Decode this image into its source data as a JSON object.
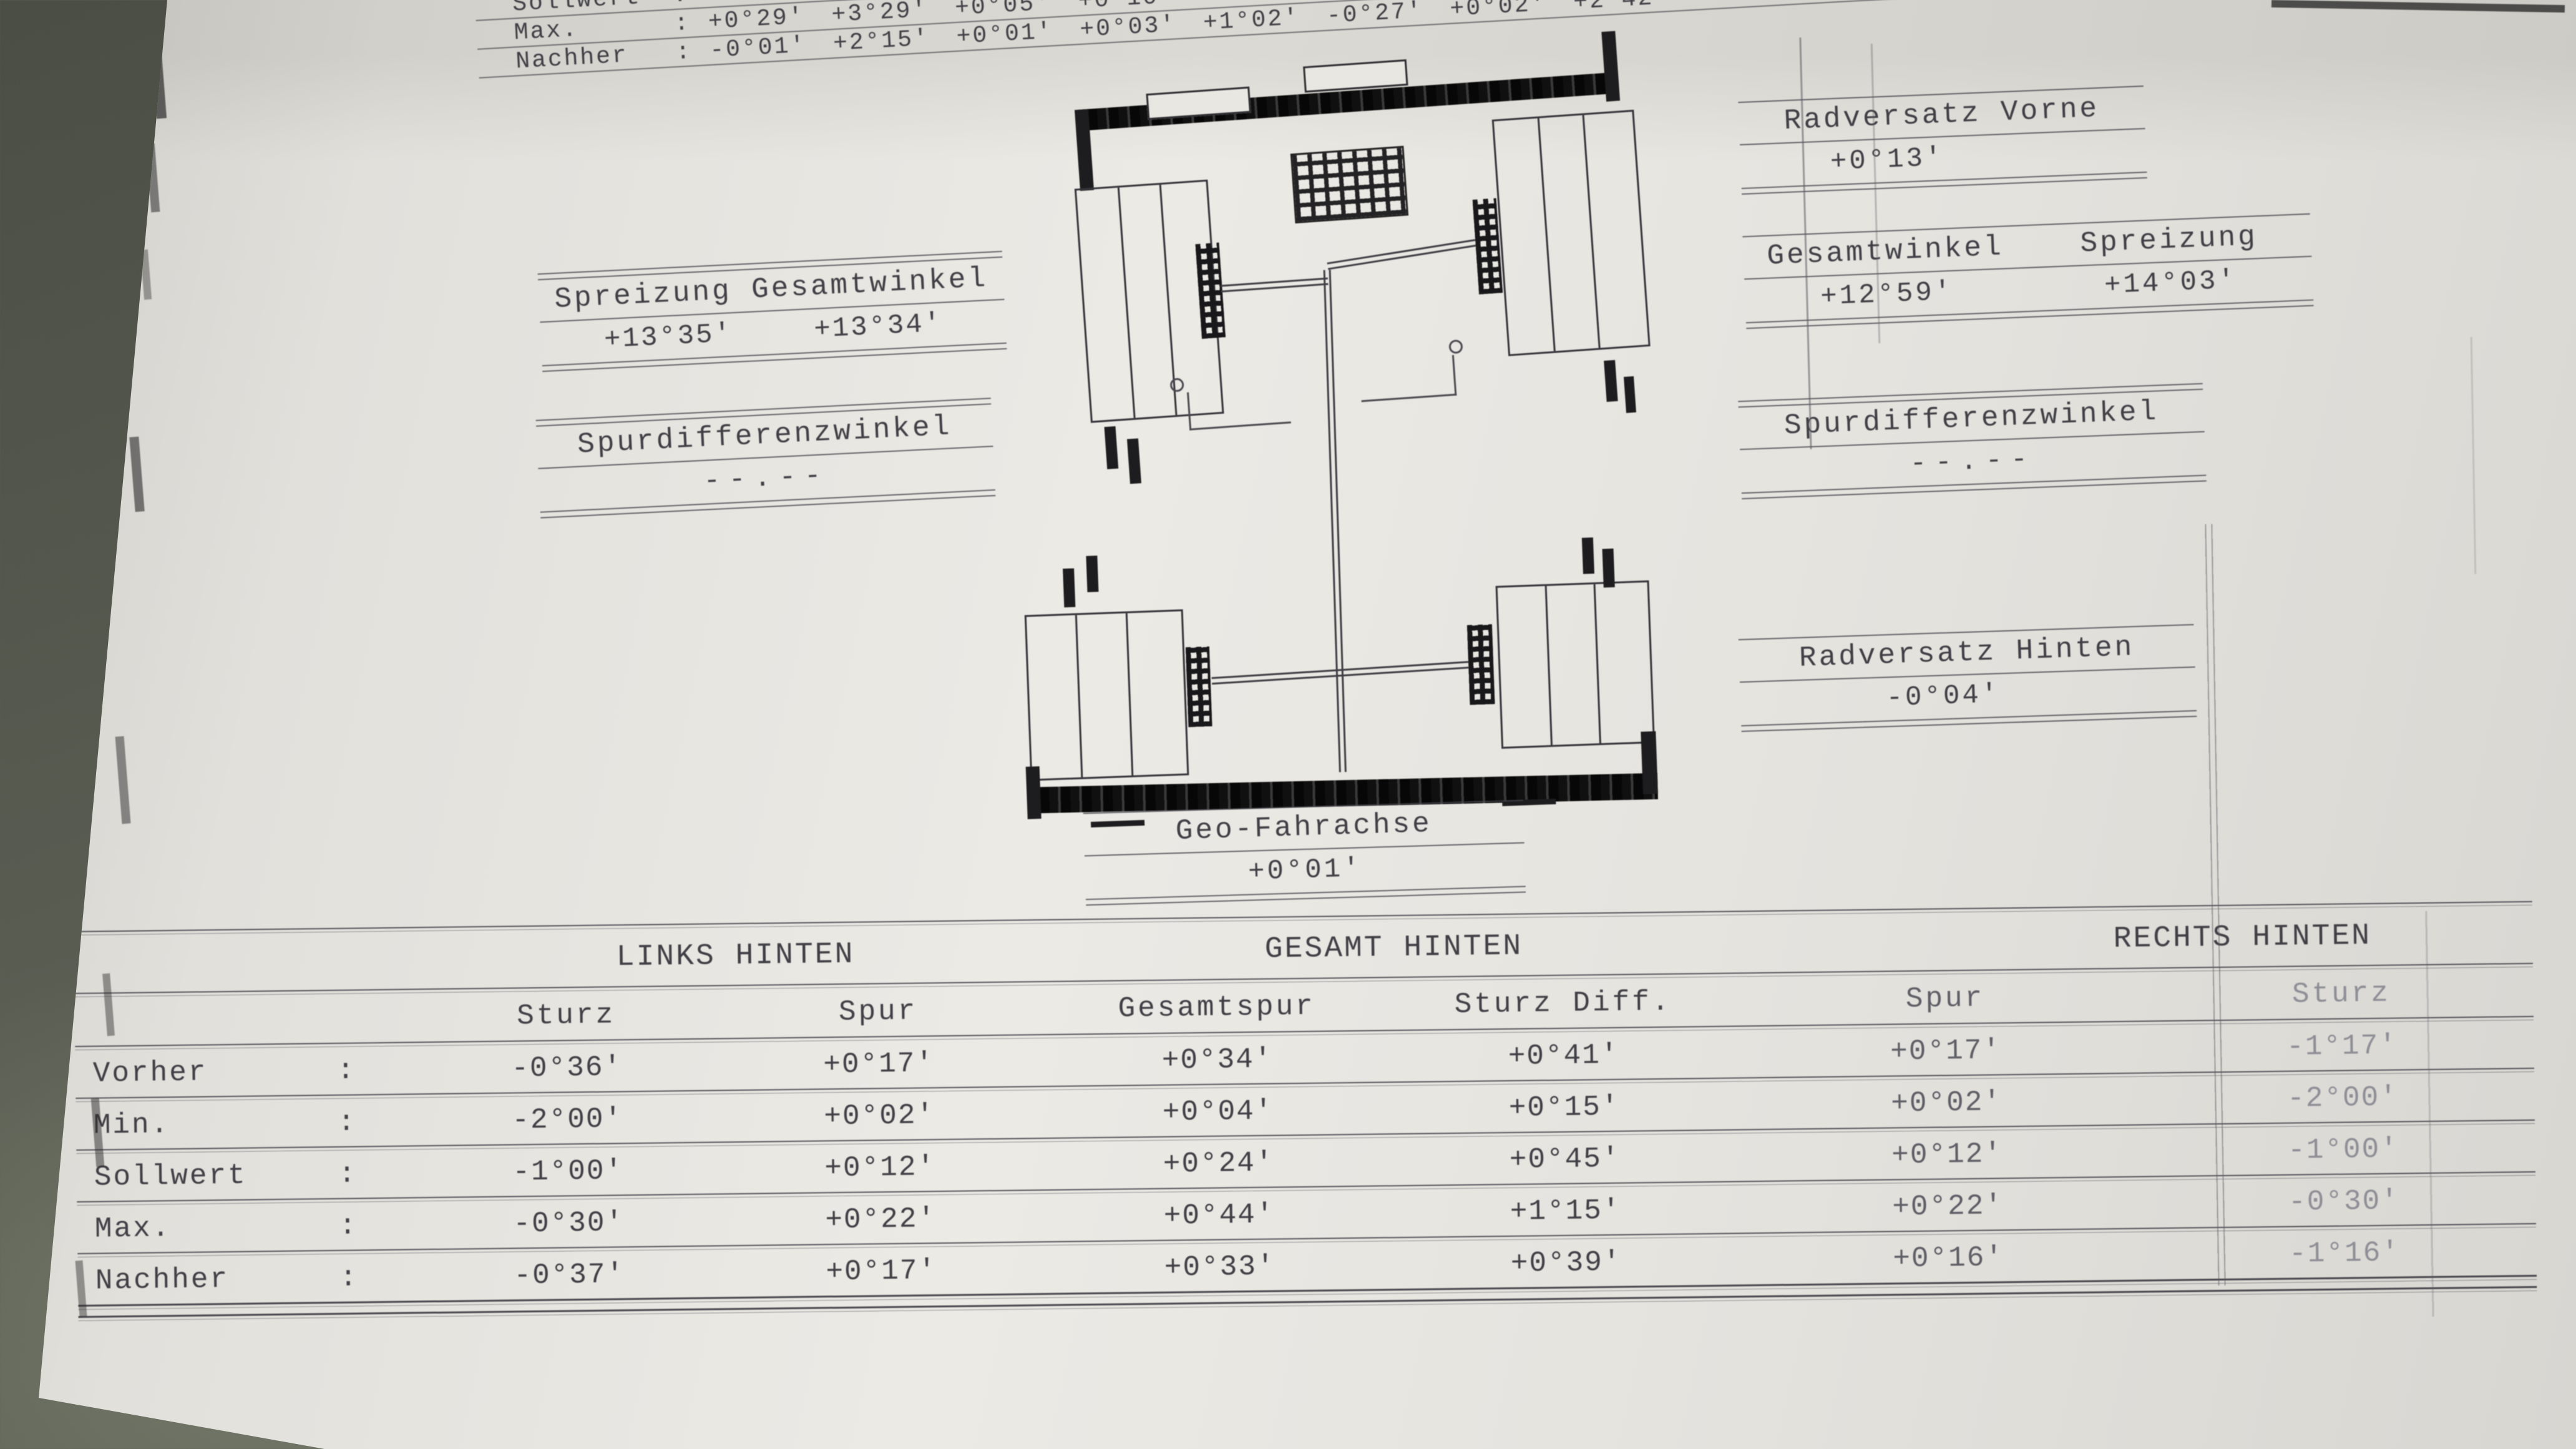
{
  "symbols": {
    "colon": ":"
  },
  "top_table": {
    "rows": [
      {
        "label": "Sollwert",
        "values": [
          "-0°37'"
        ]
      },
      {
        "label": "Max.",
        "values": [
          "+0°29'",
          "+3°29'",
          "+0°05'",
          "+0°10'"
        ]
      },
      {
        "label": "Nachher",
        "values": [
          "-0°01'",
          "+2°15'",
          "+0°01'",
          "+0°03'",
          "+1°02'",
          "-0°27'",
          "+0°02'",
          "+2°42'"
        ]
      }
    ]
  },
  "annotations": {
    "spreizung_gesamtwinkel_left": {
      "label": "Spreizung Gesamtwinkel",
      "values": [
        "+13°35'",
        "+13°34'"
      ]
    },
    "spurdifferenzwinkel_left": {
      "label": "Spurdifferenzwinkel",
      "value": "--.--"
    },
    "radversatz_vorne": {
      "label": "Radversatz Vorne",
      "value": "+0°13'"
    },
    "gesamtwinkel_spreizung_right": {
      "labels": [
        "Gesamtwinkel",
        "Spreizung"
      ],
      "values": [
        "+12°59'",
        "+14°03'"
      ]
    },
    "spurdifferenzwinkel_right": {
      "label": "Spurdifferenzwinkel",
      "value": "--.--"
    },
    "radversatz_hinten": {
      "label": "Radversatz Hinten",
      "value": "-0°04'"
    },
    "geo_fahrachse": {
      "label": "Geo-Fahrachse",
      "value": "+0°01'"
    }
  },
  "rear_table": {
    "group_headers": [
      "LINKS HINTEN",
      "GESAMT HINTEN",
      "RECHTS HINTEN"
    ],
    "column_headers": [
      "Sturz",
      "Spur",
      "Gesamtspur",
      "Sturz Diff.",
      "Spur",
      "Sturz"
    ],
    "rows": [
      {
        "label": "Vorher",
        "values": [
          "-0°36'",
          "+0°17'",
          "+0°34'",
          "+0°41'",
          "+0°17'",
          "-1°17'"
        ]
      },
      {
        "label": "Min.",
        "values": [
          "-2°00'",
          "+0°02'",
          "+0°04'",
          "+0°15'",
          "+0°02'",
          "-2°00'"
        ]
      },
      {
        "label": "Sollwert",
        "values": [
          "-1°00'",
          "+0°12'",
          "+0°24'",
          "+0°45'",
          "+0°12'",
          "-1°00'"
        ]
      },
      {
        "label": "Max.",
        "values": [
          "-0°30'",
          "+0°22'",
          "+0°44'",
          "+1°15'",
          "+0°22'",
          "-0°30'"
        ]
      },
      {
        "label": "Nachher",
        "values": [
          "-0°37'",
          "+0°17'",
          "+0°33'",
          "+0°39'",
          "+0°16'",
          "-1°16'"
        ]
      }
    ]
  }
}
